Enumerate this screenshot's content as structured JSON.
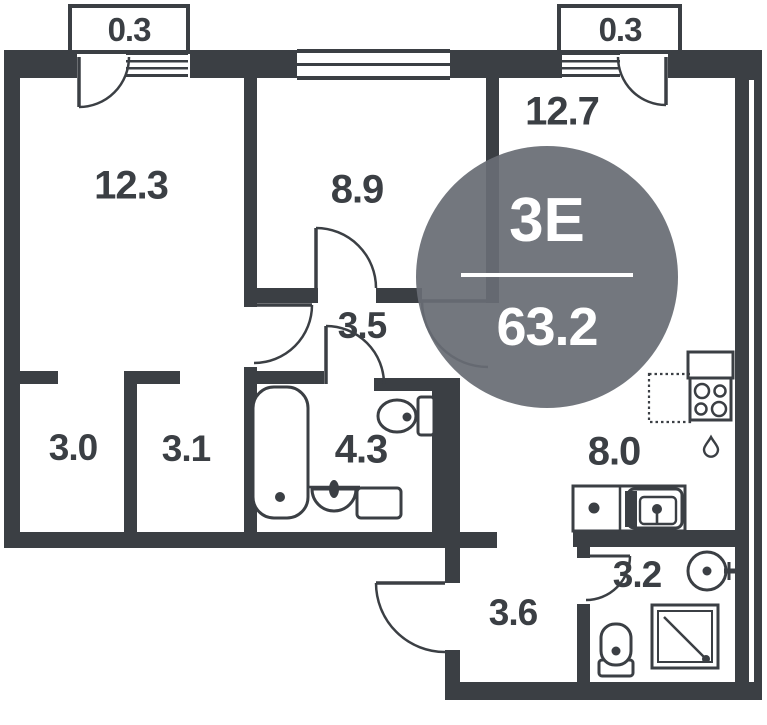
{
  "plan": {
    "badge": {
      "type": "3Е",
      "area": "63.2"
    },
    "rooms": {
      "balcony_left": "0.3",
      "balcony_right": "0.3",
      "bedroom": "12.3",
      "room2": "8.9",
      "living": "12.7",
      "hall": "3.5",
      "ward1": "3.0",
      "ward2": "3.1",
      "bath": "4.3",
      "kitchen": "8.0",
      "entry": "3.6",
      "wc": "3.2"
    },
    "colors": {
      "wall": "#3b3f44",
      "badge_bg": "#686d74",
      "badge_text": "#ffffff"
    },
    "icons": [
      "bathtub-icon",
      "toilet-icon",
      "sink-icon",
      "washing-machine-icon",
      "stove-icon",
      "fridge-icon",
      "kitchen-sink-icon",
      "shower-icon",
      "water-drop-icon",
      "window-icon",
      "door-arc-icon"
    ]
  }
}
